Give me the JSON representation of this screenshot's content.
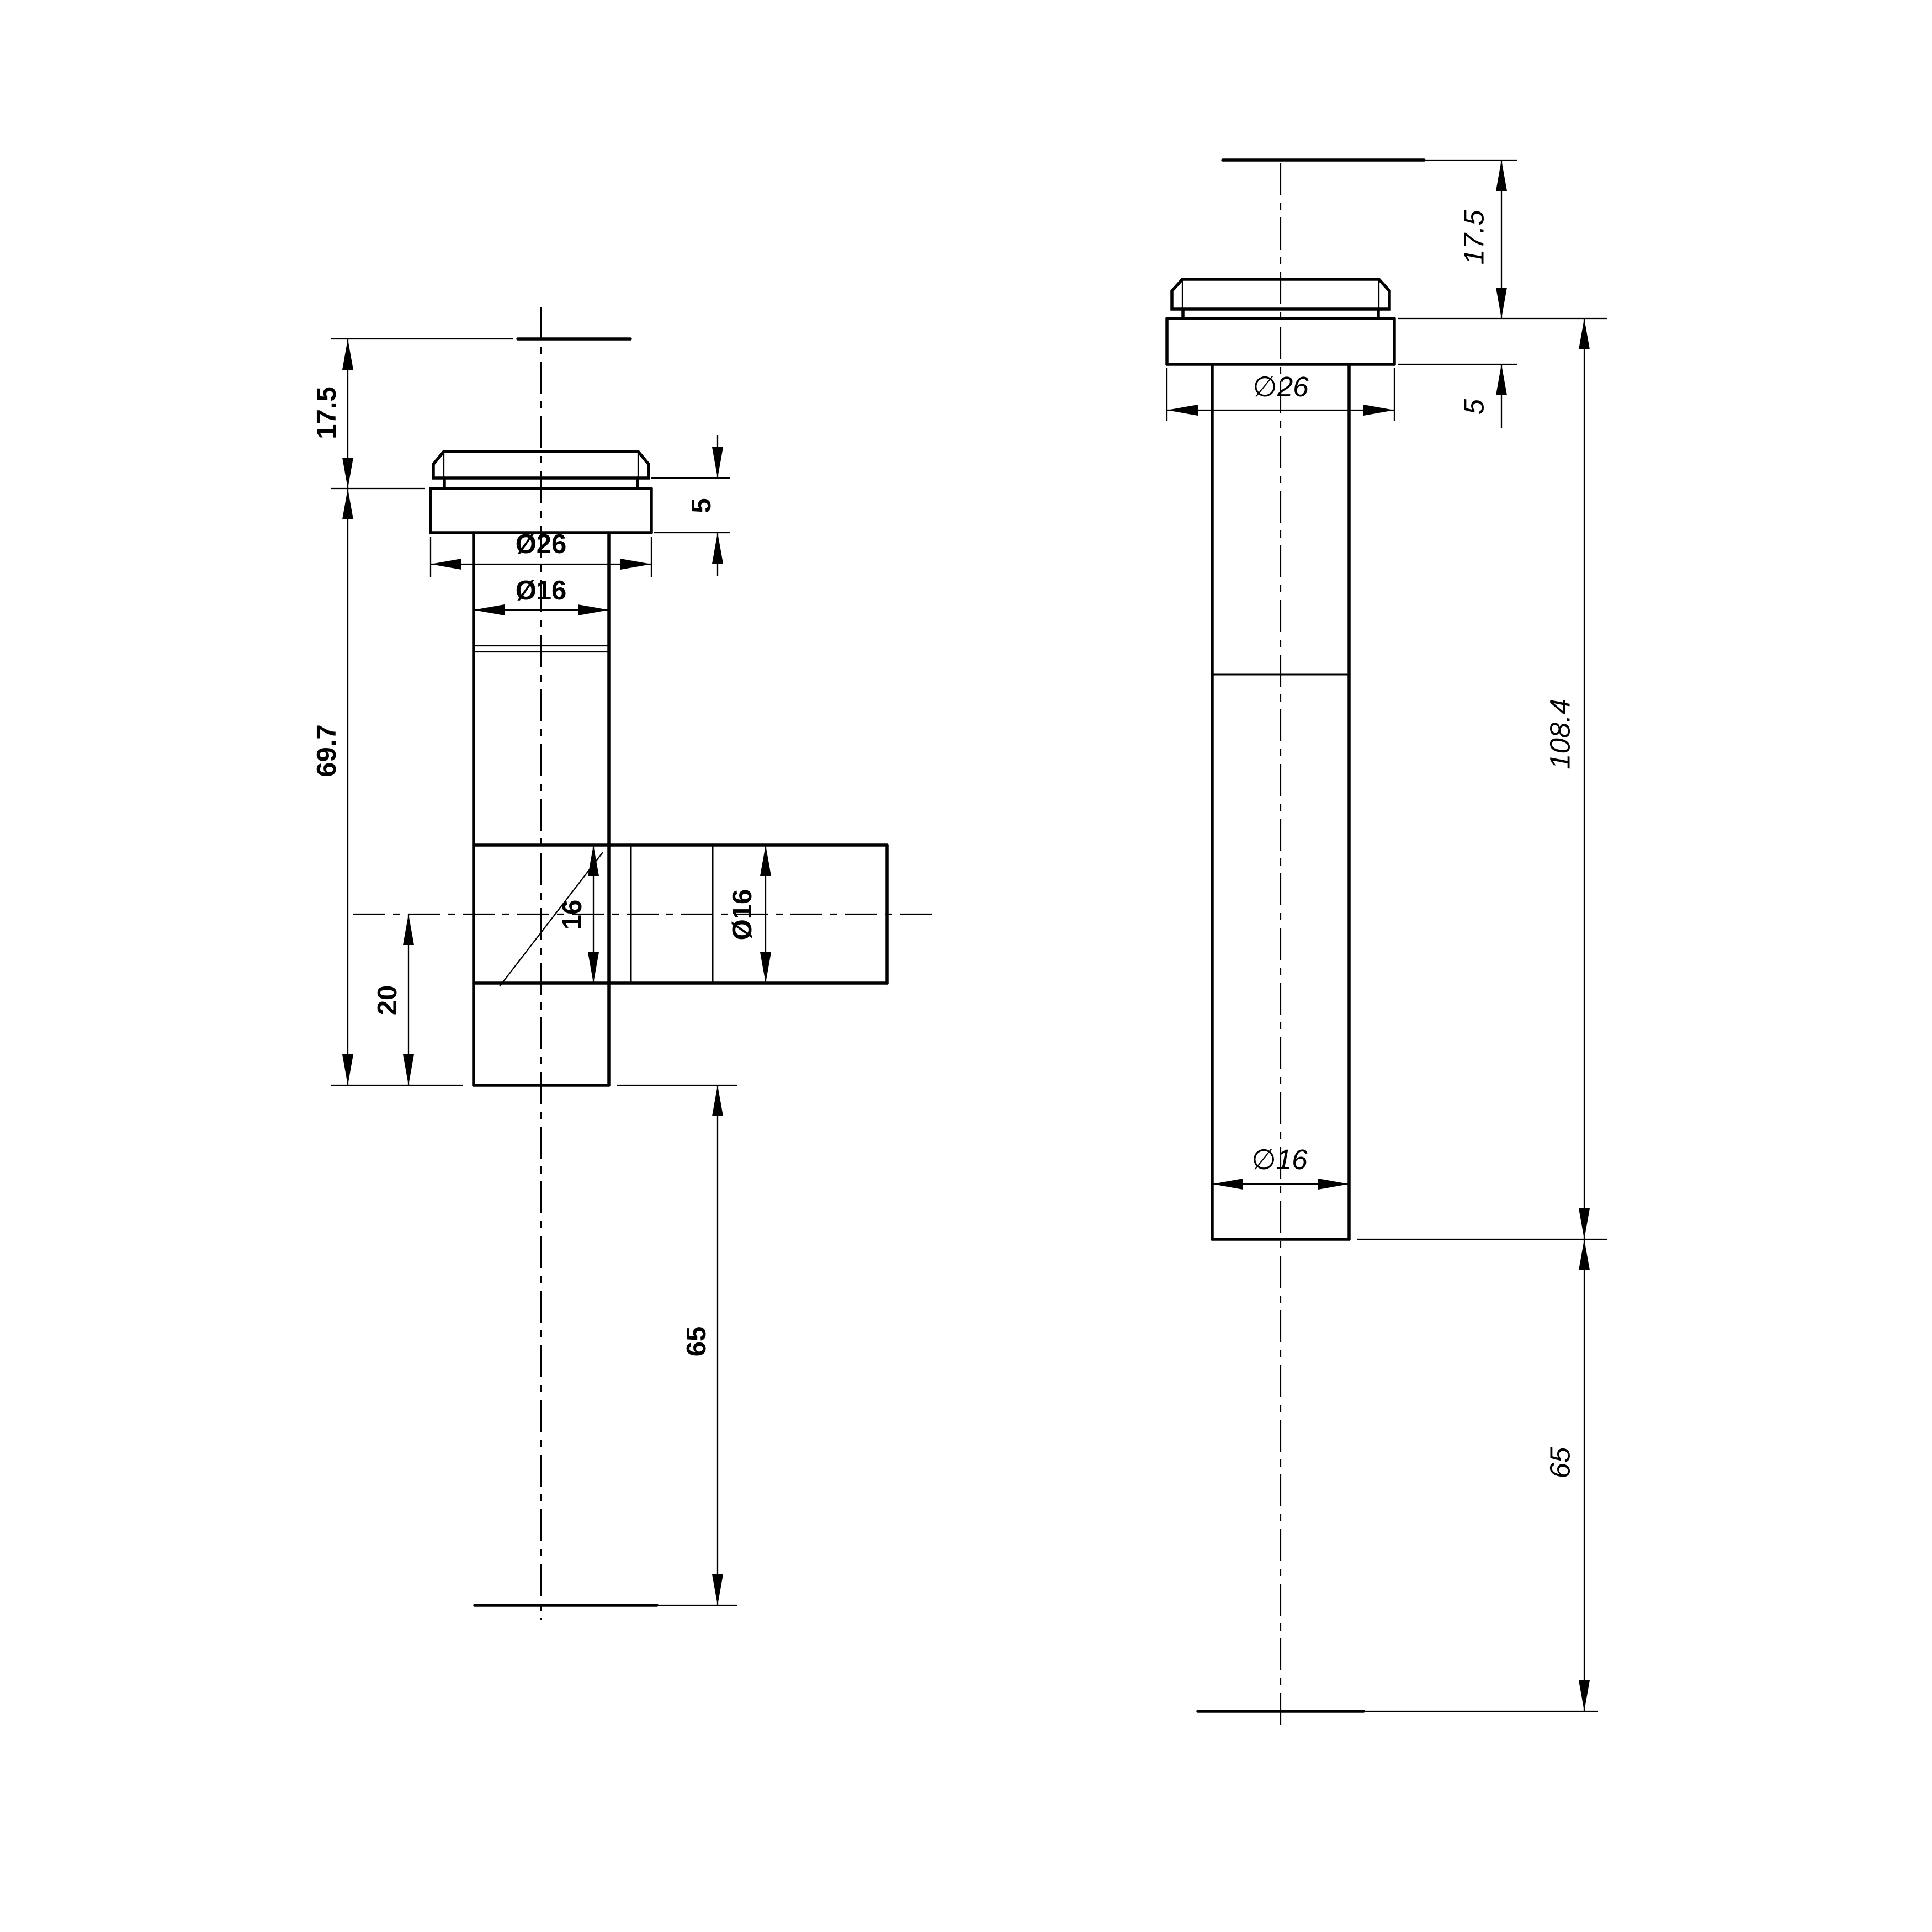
{
  "drawing": {
    "type": "cad-dimension-drawing",
    "background_color": "#ffffff",
    "line_color": "#000000",
    "views": {
      "left": {
        "name": "front view - tee fitting with flange",
        "dims": {
          "top_height": "17.5",
          "flange_thickness": "5",
          "flange_diameter": "Ø26",
          "pipe_diameter": "Ø16",
          "body_length": "69.7",
          "branch_bore": "16",
          "branch_diameter": "Ø16",
          "branch_offset": "20",
          "tail_length": "65"
        }
      },
      "right": {
        "name": "side view - straight fitting with flange",
        "dims": {
          "top_height": "17.5",
          "flange_thickness": "5",
          "flange_diameter": "∅26",
          "overall_length": "108.4",
          "pipe_diameter": "∅16",
          "tail_length": "65"
        }
      }
    }
  }
}
